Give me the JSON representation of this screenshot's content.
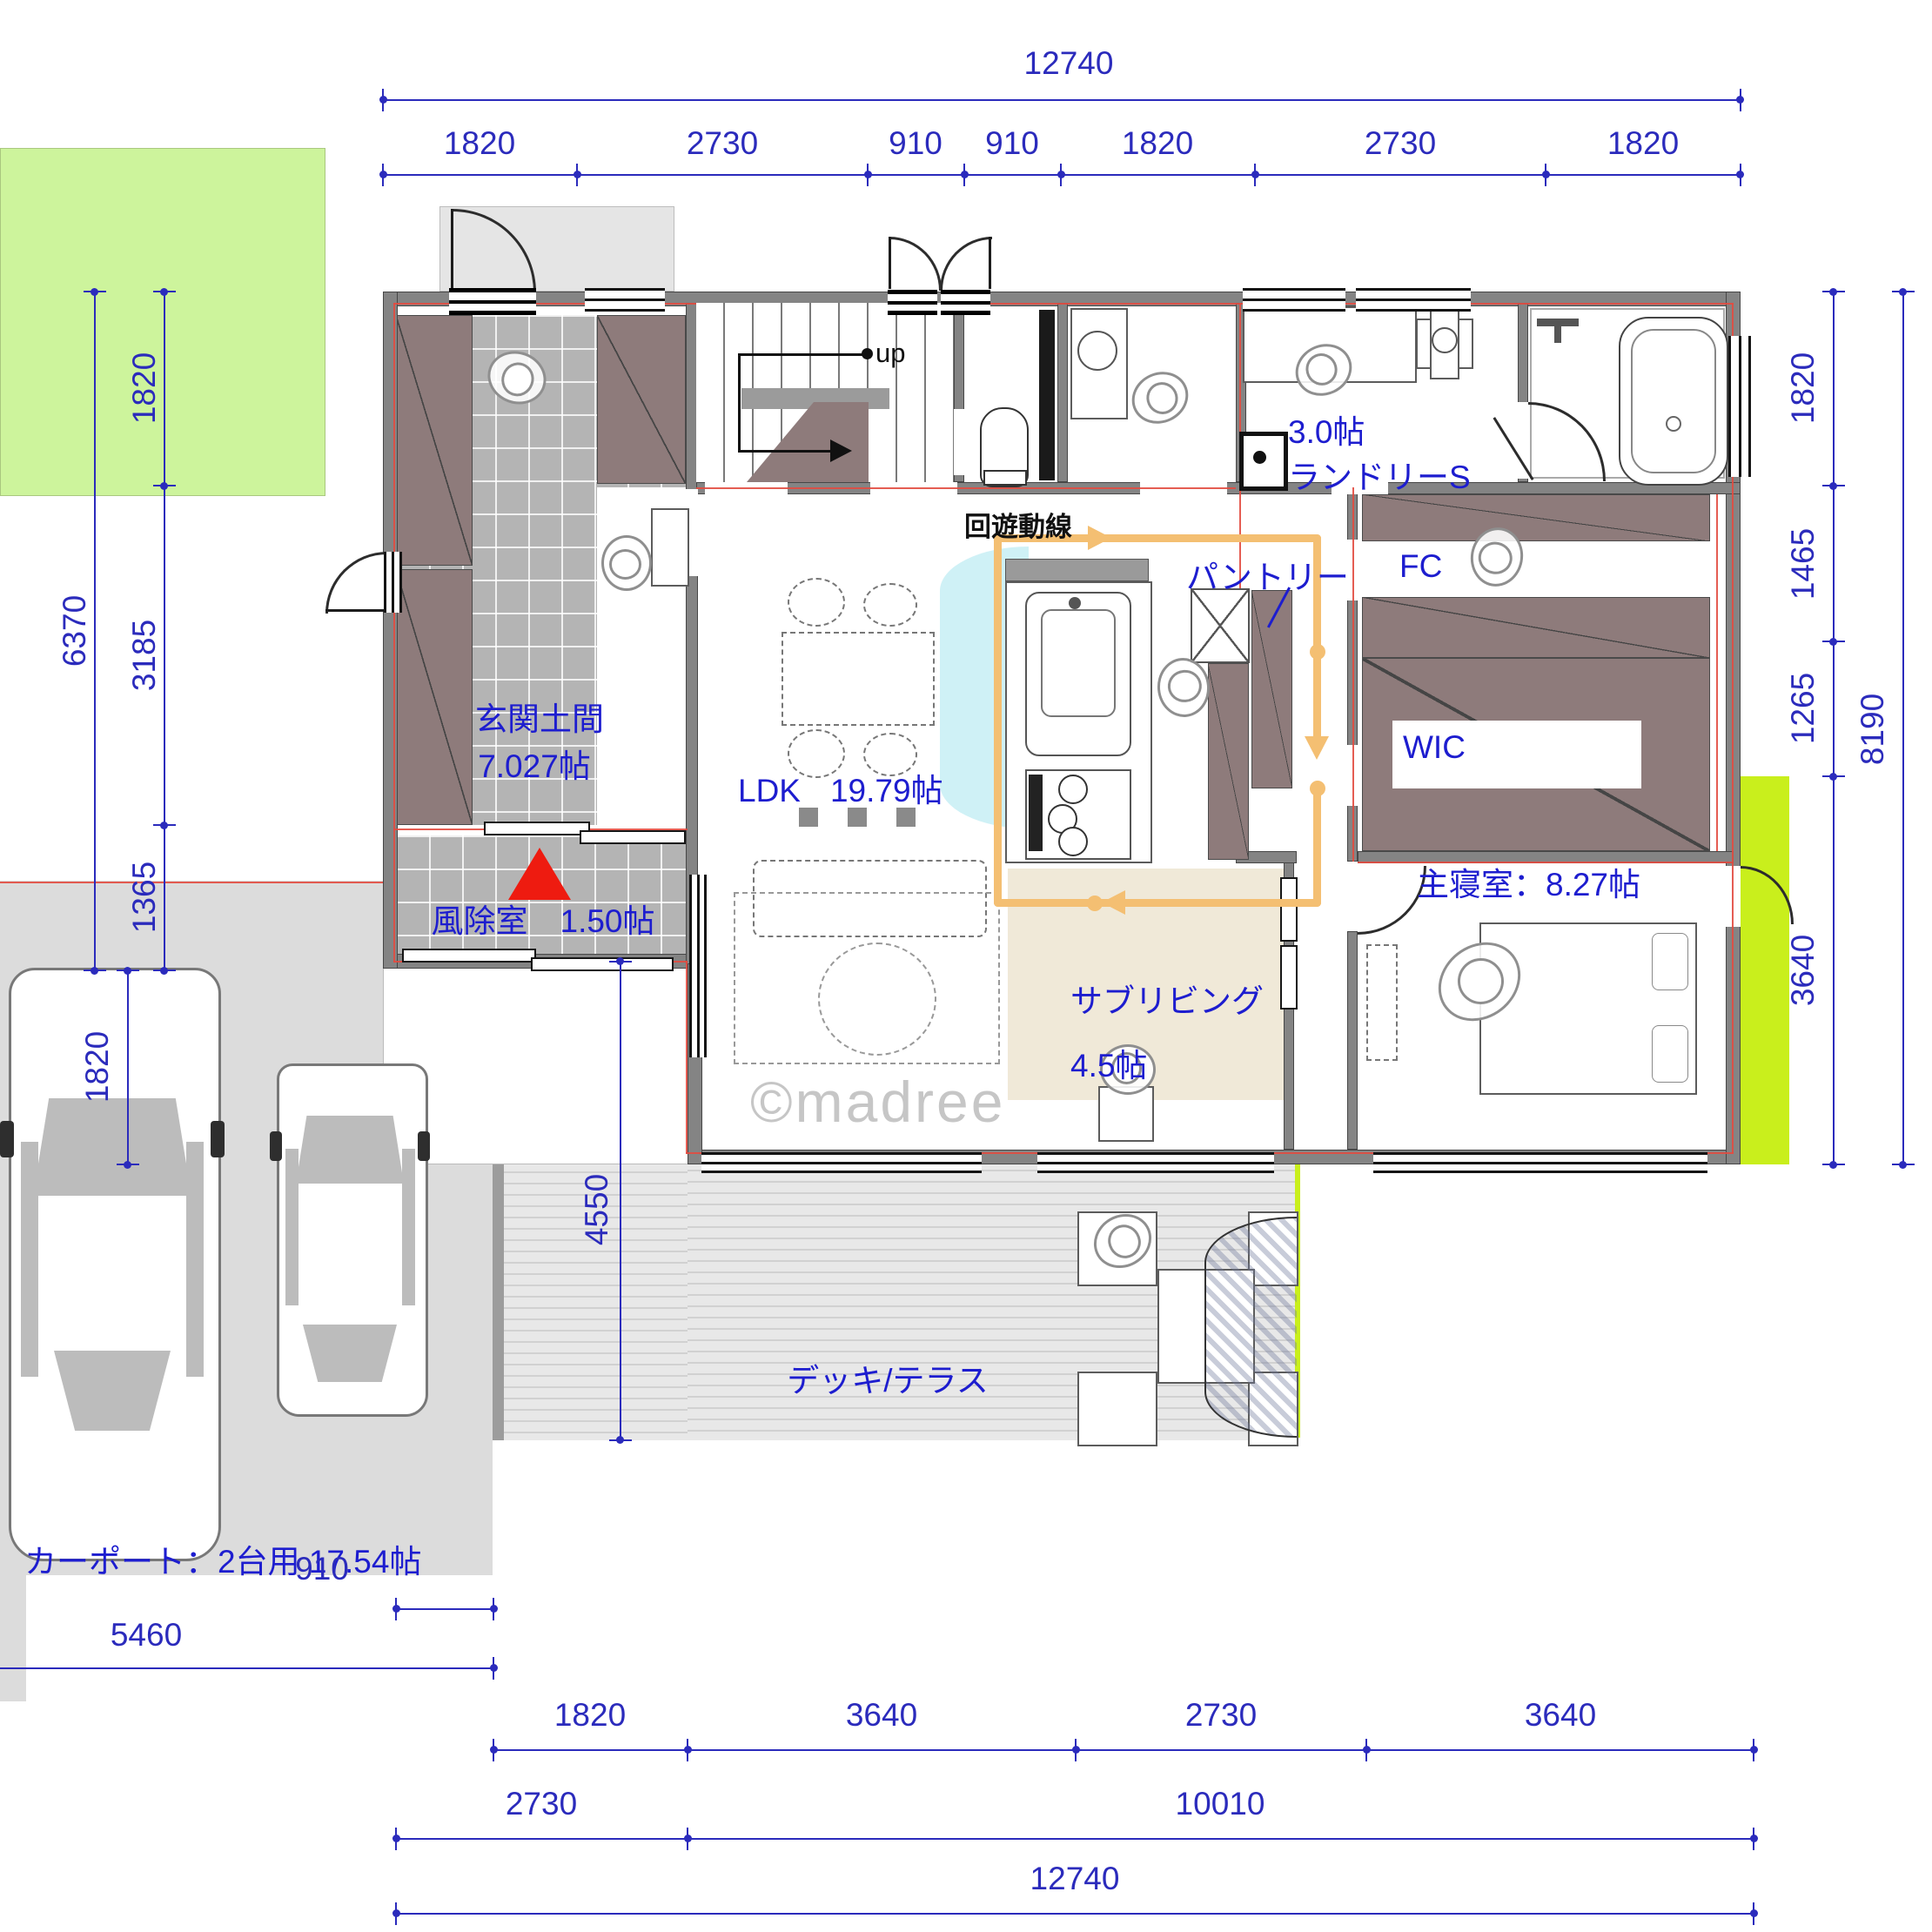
{
  "watermark": "©madree",
  "annotations": {
    "circulation": "回遊動線",
    "stairs_up": "up"
  },
  "rooms": {
    "genkan_name": "玄関土間",
    "genkan_area": "7.027帖",
    "fujo": "風除室　1.50帖",
    "ldk_name": "LDK",
    "ldk_area": "19.79帖",
    "pantry": "パントリー",
    "laundry_area": "3.0帖",
    "laundry_name": "ランドリーS",
    "fc": "FC",
    "wic": "WIC",
    "bedroom": "主寝室：8.27帖",
    "subliving_name": "サブリビング",
    "subliving_area": "4.5帖",
    "deck": "デッキ/テラス",
    "carport": "カーポート：2台用 17.54帖"
  },
  "dims": {
    "top_total": "12740",
    "top": [
      "1820",
      "2730",
      "910",
      "910",
      "1820",
      "2730",
      "1820"
    ],
    "left_outer": "6370",
    "left": [
      "1820",
      "3185",
      "1365"
    ],
    "left_carport": "1820",
    "right": [
      "1820",
      "1465",
      "1265",
      "3640"
    ],
    "right_outer": "8190",
    "deck_height": "4550",
    "carport_width": "5460",
    "offset": "910",
    "bottom_row1": [
      "1820",
      "3640",
      "2730",
      "3640"
    ],
    "bottom_row2": [
      "2730",
      "10010"
    ],
    "bottom_total": "12740"
  },
  "colors": {
    "dimension_blue": "#2b2bbc",
    "label_blue": "#1d1dcf",
    "wall_gray": "#848484",
    "closet_mauve": "#8e7b7b",
    "garden_green": "#cdf49c",
    "bright_lawn": "#c9ef1c",
    "circulation_orange": "#f4bf72",
    "subliving_beige": "#f0e9d8",
    "entrance_marker_red": "#ee1b10"
  }
}
